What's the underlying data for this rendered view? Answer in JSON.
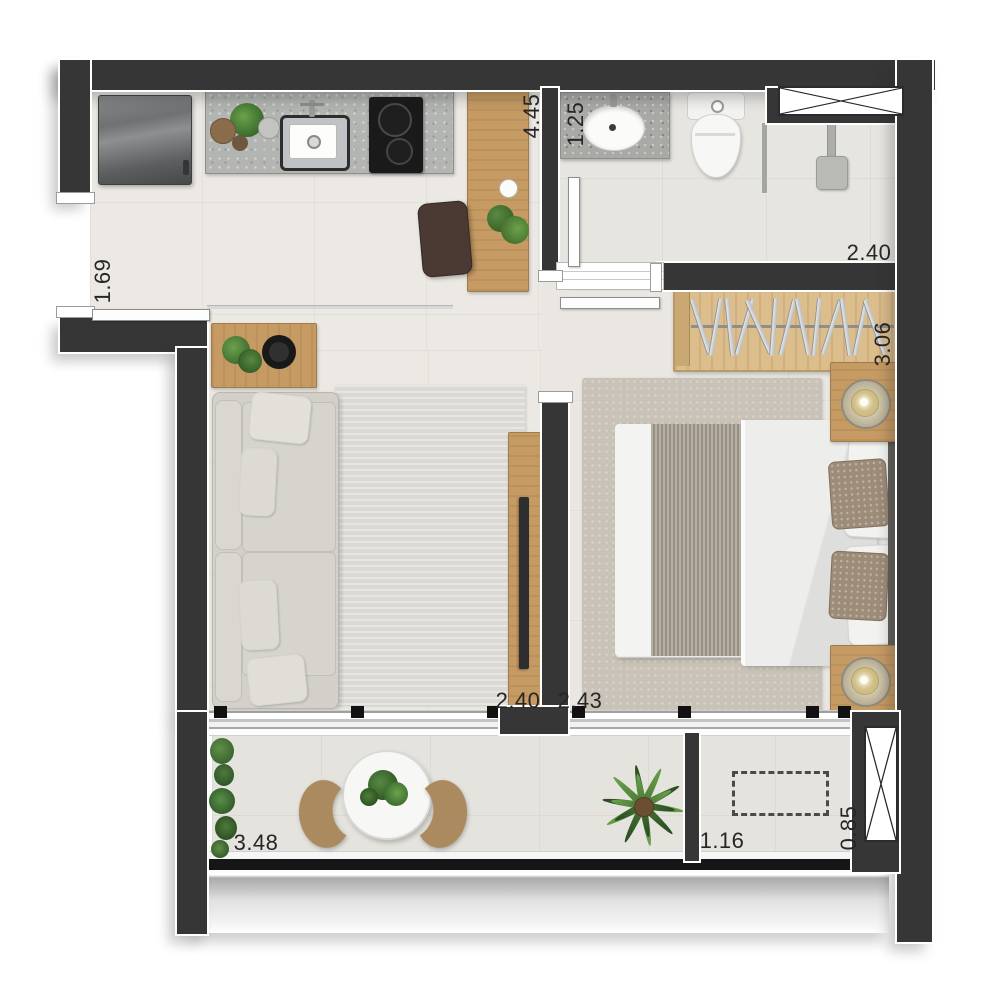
{
  "labels": {
    "kitchen_depth": "4.45",
    "bath_width": "1.25",
    "bath_length": "2.40",
    "entry_width": "1.69",
    "bedroom_depth": "3.06",
    "living_width": "2.40",
    "bedroom_width": "2.43",
    "balcony_length": "3.48",
    "small_balcony_length": "1.16",
    "small_balcony_depth": "0.85"
  },
  "colors": {
    "wall": "#363636",
    "floor_living": "#ece9e4",
    "floor_bath": "#e7e5e0",
    "floor_bedroom": "#eae7e2",
    "floor_balcony": "#e5e3de",
    "wood": "#c59a63",
    "wood_light": "#dcbd8c",
    "rug_living": "#dcd9d4",
    "rug_bedroom": "#c9c2b7",
    "sofa": "#d3d0ca",
    "counter": "#b2b5b1",
    "accent_text": "#262626",
    "plant": "#4e7f38"
  },
  "symbols": {
    "window_shaft": "crossed-box-window-symbol",
    "ac_spot": "dashed-equipment-outline"
  }
}
